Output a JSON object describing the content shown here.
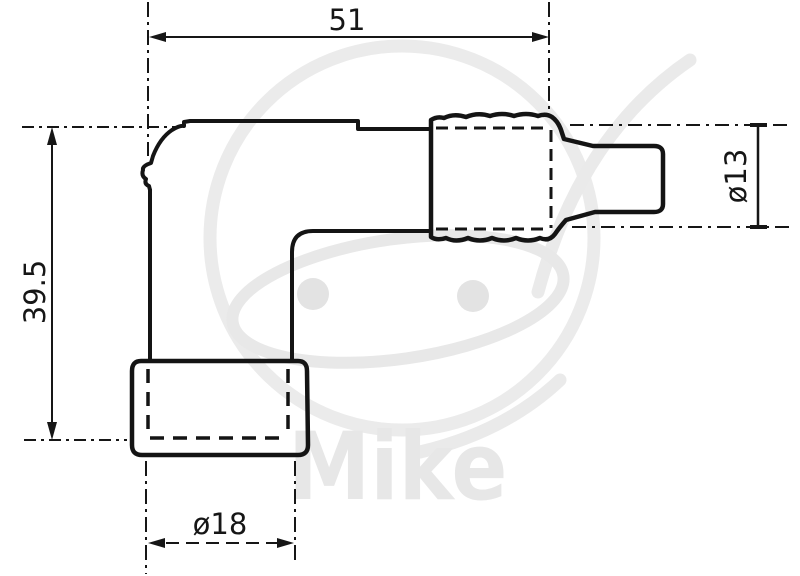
{
  "drawing": {
    "type": "technical-dimension-drawing",
    "subject": "angled spark plug cap (side profile)",
    "dimensions": {
      "top_width": "51",
      "left_height": "39.5",
      "right_diameter": "ø13",
      "bottom_diameter": "ø18"
    },
    "watermark": {
      "text": "Mike"
    },
    "colors": {
      "line": "#161616",
      "watermark": "#e8e8e8",
      "background": "#ffffff"
    }
  }
}
